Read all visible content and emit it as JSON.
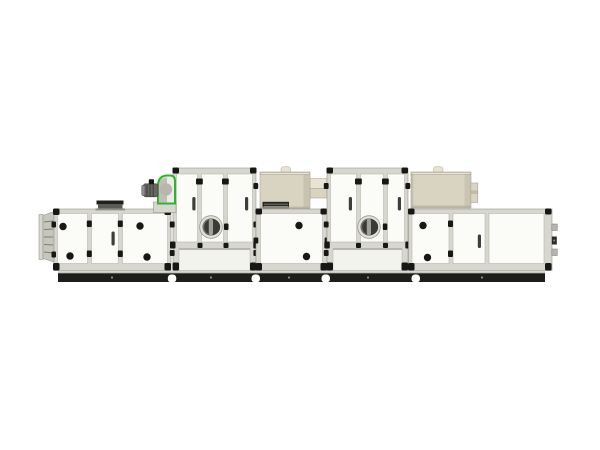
{
  "canvas": {
    "width": 600,
    "height": 450
  },
  "subject": {
    "kind": "industrial-modular-air-handling-unit",
    "view": "side-elevation-product-photo",
    "module_count": 5,
    "parts": [
      "intake-louver-flange",
      "filter-module-with-roof-vent-hood",
      "green-fan-scroll-with-motor",
      "tall-door-module-with-inspection-porthole-1",
      "beige-rotor-cassette-1-with-vent-grille",
      "mid-door-module",
      "tall-door-module-with-inspection-porthole-2",
      "beige-rotor-cassette-2",
      "right-door-module-with-side-fittings",
      "black-skid-base-rail"
    ]
  },
  "colors": {
    "bg": "#ffffff",
    "panel": "#fbfbf8",
    "panelShade": "#f3f3ed",
    "panelLine": "#b3b3a9",
    "frame": "#d7d7cf",
    "frameLine": "#97978d",
    "black": "#171715",
    "handle": "#3e3e38",
    "rail": "#1d1d1c",
    "railTop": "#c8c8c0",
    "boltDot": "#8f8f87",
    "beige": "#d9d3c2",
    "beigeLight": "#e8e3d3",
    "beigeEdge": "#a8a292",
    "shadow": "#b3ad9e",
    "green": "#2db42d",
    "fanBody": "#ecece6",
    "fanScroll": "#b7b7af",
    "fanScrollDark": "#9a9a92",
    "motor": "#686862",
    "motorDark": "#3e3e39",
    "motorCap": "#90908a",
    "hoodTop": "#1f1f1d",
    "hoodFace": "#5b5b53",
    "hoodBase": "#90908a",
    "louverFace": "#c6c6be",
    "louverLine": "#7d7d75",
    "grille": "#262622",
    "grilleSlat": "#83837b",
    "glassRim": "#e2e2dc",
    "glassMid": "#72726a",
    "glassDark": "#3b3b36",
    "glassSlat": "#a0a098",
    "shadeLine": "#a9a9a1",
    "fitting": "#b4b4ac",
    "fittingDark": "#2c2c28"
  }
}
